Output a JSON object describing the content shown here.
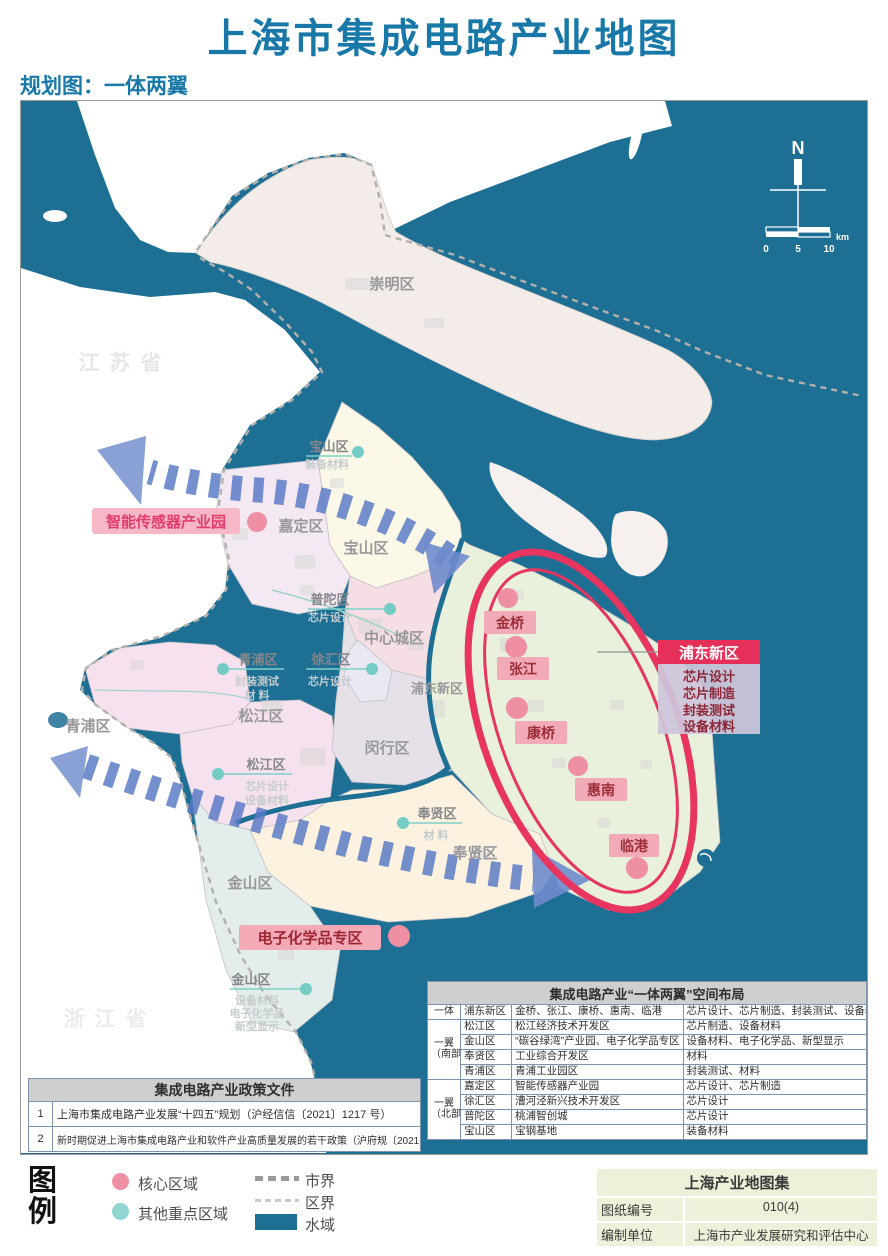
{
  "title": "上海市集成电路产业地图",
  "subtitle": "规划图：一体两翼",
  "map": {
    "provinces": {
      "jiangsu": "江苏省",
      "zhejiang": "浙江省"
    },
    "compass": {
      "north": "N"
    },
    "scalebar": {
      "t0": "0",
      "t5": "5",
      "t10": "10",
      "unit": "km"
    },
    "district_labels": [
      {
        "name": "崇明区"
      },
      {
        "name": "宝山区"
      },
      {
        "name": "嘉定区"
      },
      {
        "name": "中心城区"
      },
      {
        "name": "浦东新区"
      },
      {
        "name": "青浦区"
      },
      {
        "name": "松江区"
      },
      {
        "name": "闵行区"
      },
      {
        "name": "奉贤区"
      },
      {
        "name": "金山区"
      }
    ],
    "site_labels": [
      {
        "district": "宝山区",
        "line1": "装备材料",
        "line2": "",
        "line3": ""
      },
      {
        "district": "普陀区",
        "line1": "芯片设计",
        "line2": "",
        "line3": ""
      },
      {
        "district": "青浦区",
        "line1": "封装测试",
        "line2": "材 料",
        "line3": ""
      },
      {
        "district": "徐汇区",
        "line1": "芯片设计",
        "line2": "",
        "line3": ""
      },
      {
        "district": "松江区",
        "line1": "芯片设计",
        "line2": "设备材料",
        "line3": ""
      },
      {
        "district": "奉贤区",
        "line1": "材 料",
        "line2": "",
        "line3": ""
      },
      {
        "district": "金山区",
        "line1": "设备材料",
        "line2": "电子化学品",
        "line3": "新型显示"
      }
    ],
    "core_sites": [
      {
        "name": "金桥"
      },
      {
        "name": "张江"
      },
      {
        "name": "康桥"
      },
      {
        "name": "惠南"
      },
      {
        "name": "临港"
      }
    ],
    "special_zones": [
      {
        "name": "智能传感器产业园"
      },
      {
        "name": "电子化学品专区"
      }
    ],
    "pudong_callout": {
      "title": "浦东新区",
      "items": [
        "芯片设计",
        "芯片制造",
        "封装测试",
        "设备材料"
      ]
    }
  },
  "layout_table": {
    "title": "集成电路产业“一体两翼”空间布局",
    "groups": [
      {
        "l1": "一体",
        "l2": ""
      },
      {
        "l1": "一翼",
        "l2": "（南部）"
      },
      {
        "l1": "一翼",
        "l2": "（北部）"
      }
    ],
    "rows": [
      {
        "district": "浦东新区",
        "parks": "金桥、张江、康桥、惠南、临港",
        "industries": "芯片设计、芯片制造、封装测试、设备材料"
      },
      {
        "district": "松江区",
        "parks": "松江经济技术开发区",
        "industries": "芯片制造、设备材料"
      },
      {
        "district": "金山区",
        "parks": "“碳谷绿湾”产业园、电子化学品专区",
        "industries": "设备材料、电子化学品、新型显示"
      },
      {
        "district": "奉贤区",
        "parks": "工业综合开发区",
        "industries": "材料"
      },
      {
        "district": "青浦区",
        "parks": "青浦工业园区",
        "industries": "封装测试、材料"
      },
      {
        "district": "嘉定区",
        "parks": "智能传感器产业园",
        "industries": "芯片设计、芯片制造"
      },
      {
        "district": "徐汇区",
        "parks": "漕河泾新兴技术开发区",
        "industries": "芯片设计"
      },
      {
        "district": "普陀区",
        "parks": "桃浦智创城",
        "industries": "芯片设计"
      },
      {
        "district": "宝山区",
        "parks": "宝钢基地",
        "industries": "装备材料"
      }
    ]
  },
  "policy_table": {
    "title": "集成电路产业政策文件",
    "rows": [
      {
        "no": "1",
        "text": "上海市集成电路产业发展“十四五”规划（沪经信信〔2021〕1217 号）"
      },
      {
        "no": "2",
        "text": "新时期促进上海市集成电路产业和软件产业高质量发展的若干政策（沪府规〔2021〕18 号）"
      }
    ]
  },
  "legend": {
    "title": [
      "图",
      "例"
    ],
    "core": "核心区域",
    "secondary": "其他重点区域",
    "city_border": "市界",
    "district_border": "区界",
    "water": "水域"
  },
  "info_box": {
    "title": "上海产业地图集",
    "rows": [
      {
        "label": "图纸编号",
        "value": "010(4)"
      },
      {
        "label": "编制单位",
        "value": "上海市产业发展研究和评估中心"
      }
    ]
  },
  "colors": {
    "water": "#1d6f94",
    "core_pink": "#ee8fa4",
    "secondary_teal": "#74ccc4",
    "accent_red": "#e73059",
    "title_blue": "#1878a8"
  }
}
